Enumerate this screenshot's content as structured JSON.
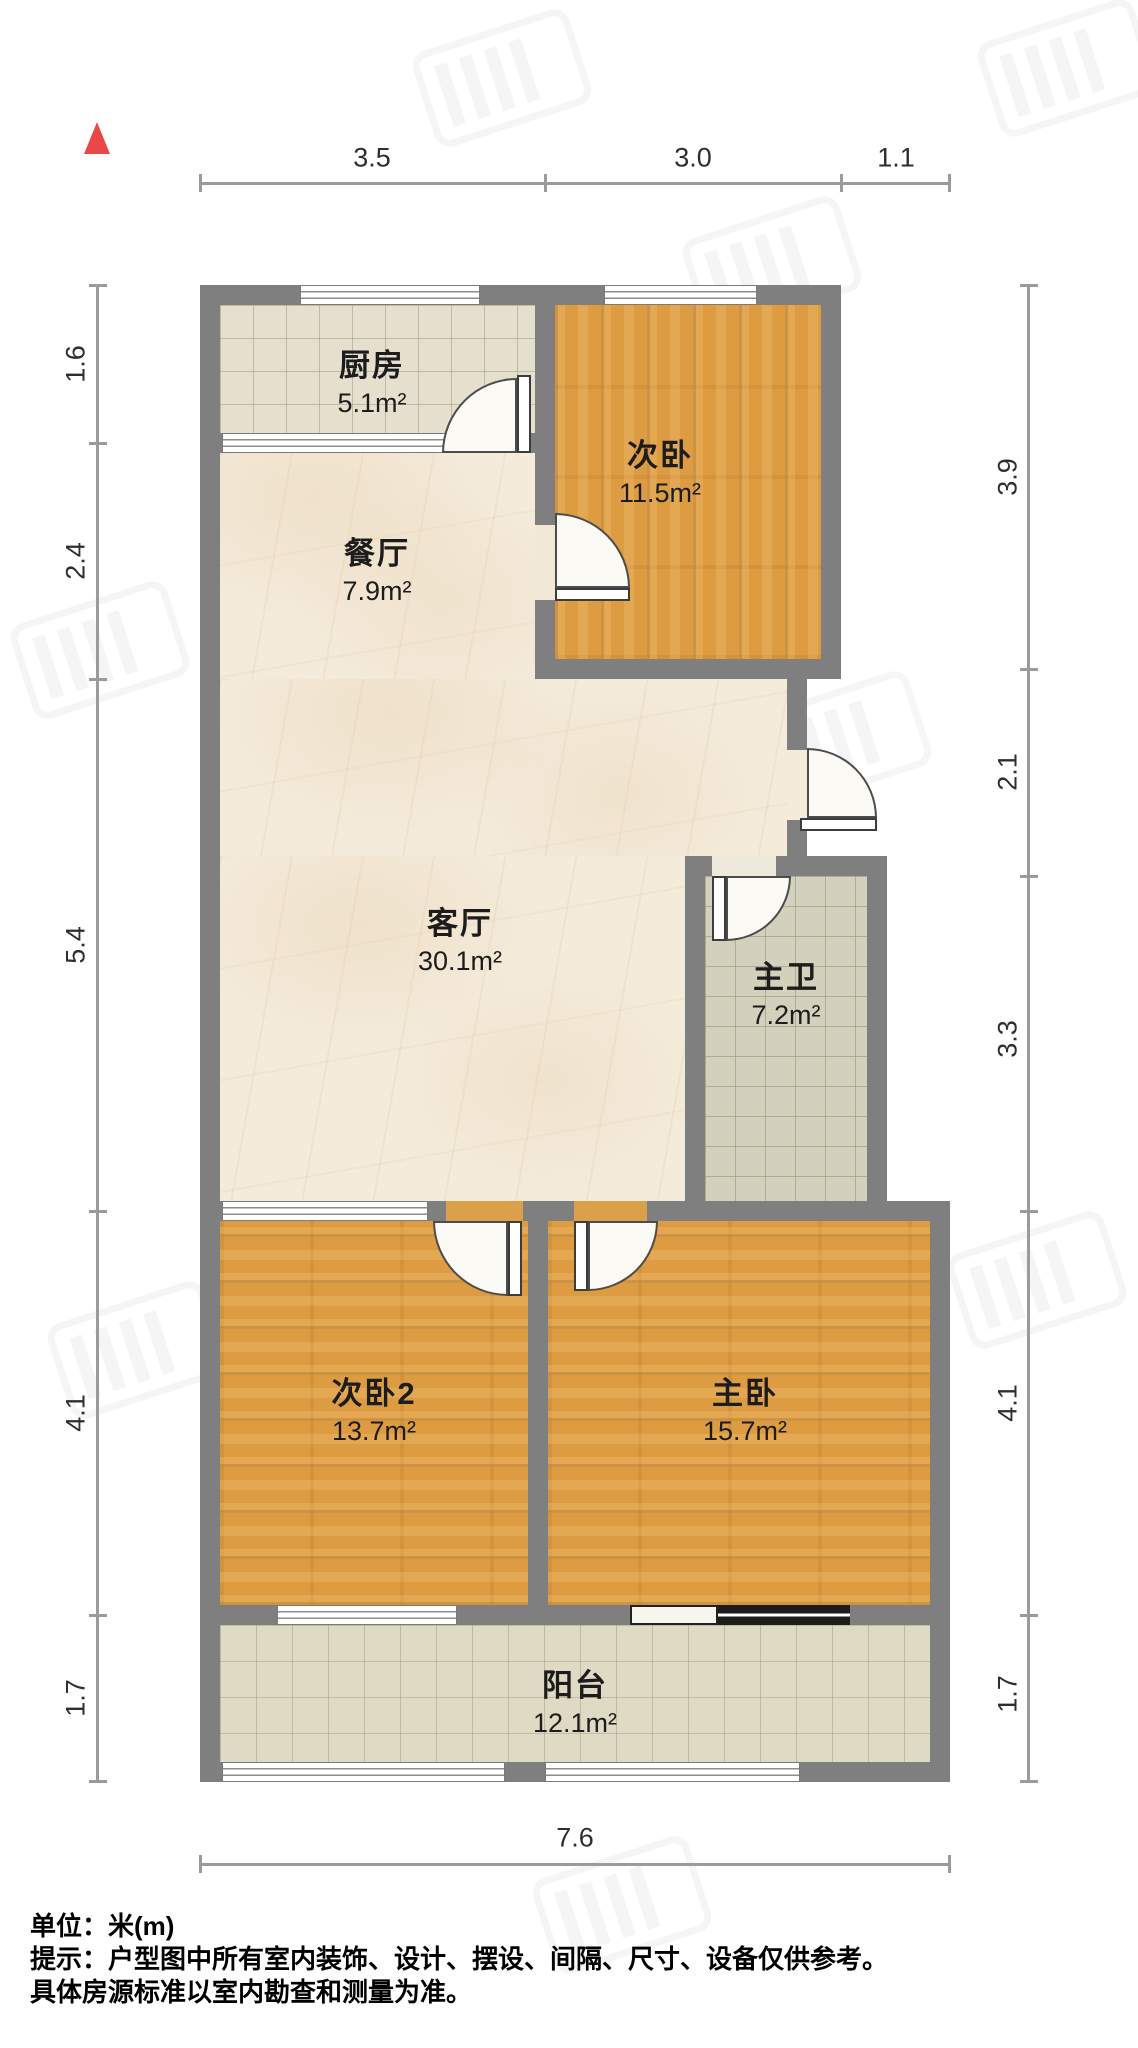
{
  "north_indicator": "north-arrow",
  "rooms": [
    {
      "name": "厨房",
      "area": "5.1m²"
    },
    {
      "name": "次卧",
      "area": "11.5m²"
    },
    {
      "name": "餐厅",
      "area": "7.9m²"
    },
    {
      "name": "客厅",
      "area": "30.1m²"
    },
    {
      "name": "主卫",
      "area": "7.2m²"
    },
    {
      "name": "次卧2",
      "area": "13.7m²"
    },
    {
      "name": "主卧",
      "area": "15.7m²"
    },
    {
      "name": "阳台",
      "area": "12.1m²"
    }
  ],
  "dimensions": {
    "top": [
      "3.5",
      "3.0",
      "1.1"
    ],
    "left": [
      "1.6",
      "2.4",
      "5.4",
      "4.1",
      "1.7"
    ],
    "right": [
      "3.9",
      "2.1",
      "3.3",
      "4.1",
      "1.7"
    ],
    "bottom": [
      "7.6"
    ]
  },
  "footer": {
    "unit_label": "单位：米(m)",
    "note_line1": "提示：户型图中所有室内装饰、设计、摆设、间隔、尺寸、设备仅供参考。",
    "note_line2": "具体房源标准以室内勘查和测量为准。"
  },
  "colors": {
    "wall": "#7f7f7f",
    "wood_floor": "#dd9b42",
    "marble_floor": "#f4ebda",
    "kitchen_tile": "#e4e0cd",
    "bath_tile": "#d3d0bb",
    "balcony_tile": "#dedac4",
    "north_arrow": "#e84848",
    "dimension_line": "#9b9b9b"
  }
}
